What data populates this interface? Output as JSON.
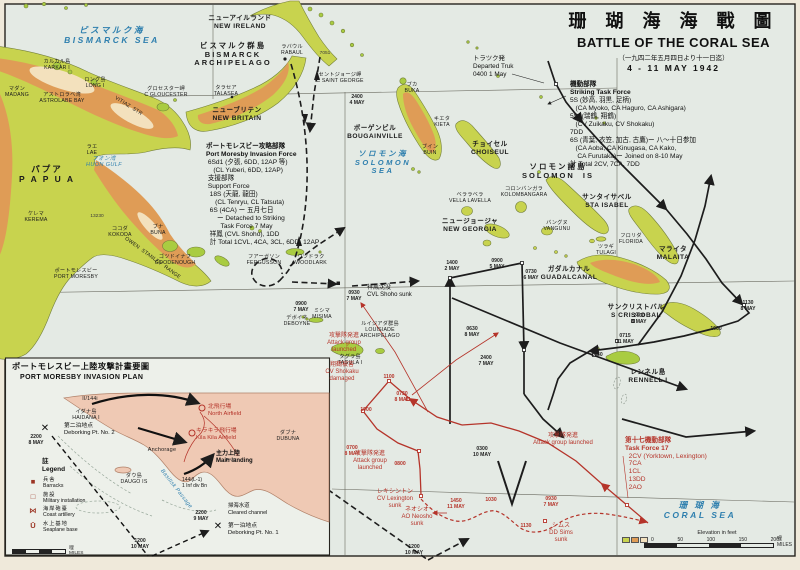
{
  "colors": {
    "sea": "#e4eae4",
    "paper": "#efe9da",
    "land": "#c8d34e",
    "land_bright": "#a9cc41",
    "highland": "#df9c56",
    "highland_light": "#f3e1bd",
    "inset_land": "#efc9b4",
    "track_black": "#1d1d1d",
    "track_red": "#b5342a",
    "sea_label": "#2e7fae",
    "frame": "#26241f"
  },
  "title": {
    "jp": "珊 瑚 海 海 戰 圖",
    "en": "BATTLE OF THE CORAL SEA",
    "date_jp": "（一九四二年五月四日より十一日迄）",
    "date_en": "4 - 11 MAY 1942"
  },
  "scales": {
    "main": {
      "caption": "Elevation in feet",
      "ticks": [
        "0",
        "50",
        "100",
        "150",
        "200"
      ],
      "unit_jp": "哩",
      "unit_en": "MILES"
    },
    "inset": {
      "unit_jp": "哩",
      "unit_en": "MILES"
    }
  },
  "inset": {
    "legend": {
      "title_jp": "註",
      "title_en": "Legend",
      "items": [
        {
          "sym": "■",
          "jp": "兵舎",
          "en": "Barracks"
        },
        {
          "sym": "□",
          "jp": "施設",
          "en": "Military installation"
        },
        {
          "sym": "⋈",
          "jp": "海岸砲臺",
          "en": "Coast artillery"
        },
        {
          "sym": "Ū",
          "jp": "水上基地",
          "en": "Seaplane base"
        }
      ]
    }
  },
  "map_labels": [
    {
      "x": 112,
      "y": 26,
      "c": "sea",
      "L": [
        "ビスマルク海",
        "BISMARCK SEA"
      ],
      "n": "bismarck-sea-label"
    },
    {
      "x": 383,
      "y": 150,
      "c": "sea",
      "s": 7.5,
      "L": [
        "ソロモン海",
        "SOLOMON",
        "SEA"
      ],
      "n": "solomon-sea-label"
    },
    {
      "x": 700,
      "y": 501,
      "c": "sea",
      "L": [
        "珊 瑚 海",
        "CORAL SEA"
      ],
      "n": "coral-sea-label"
    },
    {
      "x": 104,
      "y": 156,
      "c": "sea-sm",
      "L": [
        "フオン湾",
        "HUON GULF"
      ],
      "n": "huon-gulf-label"
    },
    {
      "x": 240,
      "y": 15,
      "c": "isl",
      "L": [
        "ニューアイルランド",
        "NEW IRELAND"
      ]
    },
    {
      "x": 233,
      "y": 42,
      "c": "isl-lg",
      "s": 7.5,
      "L": [
        "ビスマルク群島",
        "BISMARCK",
        "ARCHIPELAGO"
      ]
    },
    {
      "x": 237,
      "y": 107,
      "c": "isl",
      "L": [
        "ニューブリテン",
        "NEW BRITAIN"
      ]
    },
    {
      "x": 47,
      "y": 165,
      "c": "isl-lg",
      "L": [
        "パプア",
        "P A P U A"
      ]
    },
    {
      "x": 558,
      "y": 163,
      "c": "isl-lg",
      "s": 7.5,
      "L": [
        "ソロモン諸島",
        "SOLOMON  IS"
      ]
    },
    {
      "x": 375,
      "y": 125,
      "c": "isl",
      "L": [
        "ボーゲンビル",
        "BOUGAINVILLE"
      ]
    },
    {
      "x": 490,
      "y": 141,
      "c": "isl",
      "L": [
        "チョイセル",
        "CHOISEUL"
      ]
    },
    {
      "x": 607,
      "y": 194,
      "c": "isl",
      "L": [
        "サンタイサベル",
        "STA ISABEL"
      ]
    },
    {
      "x": 470,
      "y": 218,
      "c": "isl",
      "L": [
        "ニュージョージャ",
        "NEW GEORGIA"
      ]
    },
    {
      "x": 673,
      "y": 246,
      "c": "isl",
      "L": [
        "マライタ",
        "MALAITA"
      ]
    },
    {
      "x": 569,
      "y": 266,
      "c": "isl",
      "L": [
        "ガダルカナル",
        "GUADALCANAL"
      ]
    },
    {
      "x": 636,
      "y": 304,
      "c": "isl",
      "L": [
        "サンクリストバル",
        "S CRISTOBAL"
      ]
    },
    {
      "x": 648,
      "y": 369,
      "c": "isl",
      "L": [
        "レンネル島",
        "RENNELL I"
      ]
    },
    {
      "x": 380,
      "y": 322,
      "c": "isl-sm",
      "L": [
        "ルイジアダ群島",
        "LOUISIADE",
        "ARCHIPELAGO"
      ]
    },
    {
      "x": 292,
      "y": 45,
      "c": "isl-sm",
      "L": [
        "ラバウル",
        "RABAUL"
      ]
    },
    {
      "x": 166,
      "y": 87,
      "c": "isl-sm",
      "L": [
        "グロセスター岬",
        "C GLOUCESTER"
      ]
    },
    {
      "x": 226,
      "y": 86,
      "c": "isl-sm",
      "L": [
        "タラセア",
        "TALASEA"
      ]
    },
    {
      "x": 57,
      "y": 60,
      "c": "isl-sm",
      "L": [
        "カルカル島",
        "KARKAR I"
      ]
    },
    {
      "x": 17,
      "y": 87,
      "c": "isl-sm",
      "L": [
        "マダン",
        "MADANG"
      ]
    },
    {
      "x": 62,
      "y": 93,
      "c": "isl-sm",
      "L": [
        "アストロラベ湾",
        "ASTROLABE BAY"
      ]
    },
    {
      "x": 95,
      "y": 78,
      "c": "isl-sm",
      "L": [
        "ロング島",
        "LONG I"
      ]
    },
    {
      "x": 128,
      "y": 104,
      "c": "isl-sm",
      "r": 32,
      "L": [
        "VITIAZ  STR"
      ]
    },
    {
      "x": 92,
      "y": 145,
      "c": "isl-sm",
      "L": [
        "ラエ",
        "LAE"
      ]
    },
    {
      "x": 36,
      "y": 212,
      "c": "isl-sm",
      "L": [
        "ケレマ",
        "KEREMA"
      ]
    },
    {
      "x": 120,
      "y": 227,
      "c": "isl-sm",
      "L": [
        "ココダ",
        "KOKODA"
      ]
    },
    {
      "x": 158,
      "y": 225,
      "c": "isl-sm",
      "L": [
        "ブナ",
        "BUNA"
      ]
    },
    {
      "x": 97,
      "y": 214,
      "c": "elev",
      "L": [
        "13230"
      ]
    },
    {
      "x": 152,
      "y": 256,
      "c": "isl-sm",
      "r": 36,
      "L": [
        "OWEN  STANLEY  RANGE"
      ]
    },
    {
      "x": 76,
      "y": 269,
      "c": "isl-sm",
      "L": [
        "ポートモレスビー",
        "PORT MORESBY"
      ]
    },
    {
      "x": 175,
      "y": 255,
      "c": "isl-sm",
      "L": [
        "ゴツドイナフ",
        "GOODENOUGH"
      ]
    },
    {
      "x": 264,
      "y": 255,
      "c": "isl-sm",
      "L": [
        "フアーガソン",
        "FERGUSSON"
      ]
    },
    {
      "x": 311,
      "y": 255,
      "c": "isl-sm",
      "L": [
        "ウツドラク",
        "WOODLARK"
      ]
    },
    {
      "x": 297,
      "y": 316,
      "c": "isl-sm",
      "L": [
        "デボイネ",
        "DEBOYNE"
      ]
    },
    {
      "x": 322,
      "y": 309,
      "c": "isl-sm",
      "L": [
        "ミシマ",
        "MISIMA"
      ]
    },
    {
      "x": 350,
      "y": 355,
      "c": "isl-sm",
      "L": [
        "タグラ島",
        "TAGULA I"
      ]
    },
    {
      "x": 412,
      "y": 83,
      "c": "isl-sm",
      "L": [
        "ブカ",
        "BUKA"
      ]
    },
    {
      "x": 442,
      "y": 117,
      "c": "isl-sm",
      "L": [
        "キエタ",
        "KIETA"
      ]
    },
    {
      "x": 430,
      "y": 145,
      "c": "isl-sm",
      "L": [
        "ブイン",
        "BUIN"
      ]
    },
    {
      "x": 340,
      "y": 73,
      "c": "isl-sm",
      "L": [
        "セントジョージ岬",
        "C SAINT GEORGE"
      ]
    },
    {
      "x": 325,
      "y": 51,
      "c": "elev",
      "L": [
        "7051"
      ]
    },
    {
      "x": 524,
      "y": 187,
      "c": "isl-sm",
      "L": [
        "コロンバンガラ",
        "KOLOMBANGARA"
      ]
    },
    {
      "x": 470,
      "y": 193,
      "c": "isl-sm",
      "L": [
        "ベララベラ",
        "VELLA LAVELLA"
      ]
    },
    {
      "x": 557,
      "y": 221,
      "c": "isl-sm",
      "L": [
        "バングヌ",
        "VANGUNU"
      ]
    },
    {
      "x": 631,
      "y": 234,
      "c": "isl-sm",
      "L": [
        "フロリダ",
        "FLORIDA"
      ]
    },
    {
      "x": 606,
      "y": 245,
      "c": "isl-sm",
      "L": [
        "ツラギ",
        "TULAGI"
      ]
    },
    {
      "x": 473,
      "y": 55,
      "c": "blk",
      "s": 6.4,
      "lf": 1,
      "L": [
        "トラツク発",
        "Departed Truk",
        "0400 1 May"
      ],
      "n": "departed-truk-note"
    },
    {
      "x": 570,
      "y": 81,
      "c": "blk hb",
      "s": 6.6,
      "lf": 1,
      "n": "striking-task-force-note",
      "L": [
        "機動部隊",
        "Striking Task Force",
        "5S (妙高, 羽黒, 足柄)",
        "   (CA Myoko, CA Haguro, CA Ashigara)",
        "5Sf (瑞鶴, 翔鶴)",
        "   (CV Zuikaku, CV Shokaku)",
        "7DD",
        "6S (青葉, 衣笠, 加古, 古鷹)ー 八〜十日参加",
        "   (CA Aoba, CA Kinugasa, CA Kako,",
        "    CA Furutaka)ー Joined on 8-10 May",
        "計 Total 2CV, 7CA, 7DD"
      ]
    },
    {
      "x": 206,
      "y": 143,
      "c": "blk hb",
      "s": 6.6,
      "lf": 1,
      "n": "port-moresby-invasion-force-note",
      "L": [
        "ポートモレスビー攻略部隊",
        "Port Moresby Invasion Force",
        " 6Sd1 (夕張, 6DD, 12AP 等)",
        "    (CL Yuberi, 6DD, 12AP)",
        " 支援部隊",
        " Support Force",
        "  18S (天龍, 龍田)",
        "     (CL Tenryu, CL Tatsuta)",
        "  6S (4CA) ー 五月七日",
        "      ー Detached to Striking",
        "        Task Force 7 May",
        "  祥鳳 (CVL Shoho), 1DD",
        "  計 Total 1CVL, 4CA, 3CL, 6DD, 12AP"
      ]
    },
    {
      "x": 625,
      "y": 437,
      "c": "rblk hb",
      "s": 6.6,
      "lf": 1,
      "n": "task-force-17-note",
      "L": [
        "第十七機動部隊",
        "Task Force 17",
        "  2CV (Yorktown, Lexington)",
        "  7CA",
        "  1CL",
        "  13DD",
        "  2AO"
      ]
    },
    {
      "x": 367,
      "y": 285,
      "c": "blk",
      "s": 6,
      "lf": 1,
      "L": [
        "祥鳳沈没",
        "CVL Shoho sunk"
      ],
      "n": "shoho-sunk-note"
    },
    {
      "x": 344,
      "y": 333,
      "c": "red",
      "L": [
        "攻撃隊発進",
        "Attack group",
        "launched"
      ],
      "n": "attack-group-launched-note"
    },
    {
      "x": 342,
      "y": 362,
      "c": "red",
      "L": [
        "翔鶴被害",
        "CV Shokaku",
        "damaged"
      ],
      "n": "shokaku-damaged-note"
    },
    {
      "x": 370,
      "y": 451,
      "c": "red",
      "L": [
        "攻撃隊発進",
        "Attack group",
        "launched"
      ],
      "n": "attack-group-launched-note"
    },
    {
      "x": 563,
      "y": 433,
      "c": "red",
      "L": [
        "攻撃隊発進",
        "Attack group launched"
      ],
      "n": "attack-group-launched-note"
    },
    {
      "x": 395,
      "y": 489,
      "c": "red",
      "L": [
        "レキシントン",
        "CV Lexington",
        "sunk"
      ],
      "n": "lexington-sunk-note"
    },
    {
      "x": 417,
      "y": 507,
      "c": "red",
      "L": [
        "ネオシオ",
        "AO Neosho",
        "sunk"
      ],
      "n": "neosho-sunk-note"
    },
    {
      "x": 561,
      "y": 523,
      "c": "red",
      "L": [
        "シムス",
        "DD Sims",
        "sunk"
      ],
      "n": "sims-sunk-note"
    },
    {
      "x": 357,
      "y": 95,
      "c": "time",
      "L": [
        "2400",
        "4 MAY"
      ]
    },
    {
      "x": 452,
      "y": 261,
      "c": "time",
      "L": [
        "1400",
        "2 MAY"
      ]
    },
    {
      "x": 497,
      "y": 259,
      "c": "time",
      "L": [
        "0900",
        "5 MAY"
      ]
    },
    {
      "x": 531,
      "y": 270,
      "c": "time",
      "L": [
        "0730",
        "6 MAY"
      ]
    },
    {
      "x": 472,
      "y": 327,
      "c": "time",
      "L": [
        "0630",
        "8 MAY"
      ]
    },
    {
      "x": 486,
      "y": 356,
      "c": "time",
      "L": [
        "2400",
        "7 MAY"
      ]
    },
    {
      "x": 639,
      "y": 314,
      "c": "time",
      "L": [
        "2400",
        "8 MAY"
      ]
    },
    {
      "x": 748,
      "y": 301,
      "c": "time",
      "L": [
        "1130",
        "8 MAY"
      ]
    },
    {
      "x": 625,
      "y": 334,
      "c": "time",
      "L": [
        "0715",
        "11 MAY"
      ]
    },
    {
      "x": 716,
      "y": 327,
      "c": "time",
      "L": [
        "1600"
      ]
    },
    {
      "x": 597,
      "y": 353,
      "c": "time",
      "L": [
        "1630"
      ]
    },
    {
      "x": 482,
      "y": 447,
      "c": "time",
      "L": [
        "0300",
        "10 MAY"
      ]
    },
    {
      "x": 414,
      "y": 545,
      "c": "time",
      "L": [
        "1200",
        "10 MAY"
      ]
    },
    {
      "x": 354,
      "y": 291,
      "c": "time",
      "L": [
        "0930",
        "7 MAY"
      ]
    },
    {
      "x": 301,
      "y": 302,
      "c": "time",
      "L": [
        "0900",
        "7 MAY"
      ]
    },
    {
      "x": 352,
      "y": 446,
      "c": "rtime",
      "L": [
        "0700",
        "8 MAY"
      ]
    },
    {
      "x": 400,
      "y": 462,
      "c": "rtime",
      "L": [
        "0800"
      ]
    },
    {
      "x": 389,
      "y": 375,
      "c": "rtime",
      "L": [
        "1100"
      ]
    },
    {
      "x": 366,
      "y": 408,
      "c": "rtime",
      "L": [
        "1900"
      ]
    },
    {
      "x": 402,
      "y": 392,
      "c": "rtime",
      "L": [
        "0730",
        "8 MAY"
      ]
    },
    {
      "x": 551,
      "y": 497,
      "c": "rtime",
      "L": [
        "0930",
        "7 MAY"
      ]
    },
    {
      "x": 491,
      "y": 498,
      "c": "rtime",
      "L": [
        "1030"
      ]
    },
    {
      "x": 526,
      "y": 524,
      "c": "rtime",
      "L": [
        "1130"
      ]
    },
    {
      "x": 456,
      "y": 499,
      "c": "rtime",
      "L": [
        "1450",
        "11 MAY"
      ]
    },
    {
      "x": 12,
      "y": 362,
      "c": "ititle",
      "lf": 1,
      "L": [
        "ポートモレスビー上陸攻撃計畫要圖"
      ],
      "n": "inset-title-jp"
    },
    {
      "x": 20,
      "y": 374,
      "c": "ititle",
      "s": 7,
      "lf": 1,
      "L": [
        "PORT MORESBY INVASION PLAN"
      ],
      "n": "inset-title-en"
    },
    {
      "x": 90,
      "y": 397,
      "c": "isl-sm",
      "L": [
        "II/144i"
      ]
    },
    {
      "x": 86,
      "y": 410,
      "c": "isl-sm",
      "L": [
        "イダナ島",
        "HAIDANA I"
      ]
    },
    {
      "x": 64,
      "y": 423,
      "c": "blk",
      "s": 5.8,
      "lf": 1,
      "L": [
        "第二泊地点",
        "Deborking Pt. No. 2"
      ],
      "n": "deboarding-point-2-label"
    },
    {
      "x": 36,
      "y": 435,
      "c": "time",
      "L": [
        "2200",
        "8 MAY"
      ]
    },
    {
      "x": 162,
      "y": 447,
      "c": "isl-sm",
      "s": 5.5,
      "L": [
        "Anchorage"
      ]
    },
    {
      "x": 134,
      "y": 474,
      "c": "isl-sm",
      "L": [
        "ダウ島",
        "DAUGO IS"
      ]
    },
    {
      "x": 208,
      "y": 404,
      "c": "rblk",
      "s": 5.8,
      "lf": 1,
      "L": [
        "北飛行場",
        "North Airfield"
      ],
      "n": "north-airfield-label"
    },
    {
      "x": 196,
      "y": 428,
      "c": "rblk",
      "s": 5.8,
      "lf": 1,
      "L": [
        "キラキラ飛行場",
        "Kila Kila Airfield"
      ],
      "n": "kila-kila-airfield-label"
    },
    {
      "x": 216,
      "y": 451,
      "c": "mld",
      "lf": 1,
      "L": [
        "主力上陸",
        "Main landing"
      ],
      "n": "main-landing-label"
    },
    {
      "x": 182,
      "y": 477,
      "c": "blk",
      "s": 5,
      "lf": 1,
      "L": [
        "144i(L-1)",
        "1 Inf div Bn"
      ]
    },
    {
      "x": 288,
      "y": 431,
      "c": "isl-sm",
      "L": [
        "ダブナ",
        "DUBUNA"
      ]
    },
    {
      "x": 231,
      "y": 458,
      "c": "elev",
      "L": [
        "PARI"
      ]
    },
    {
      "x": 228,
      "y": 523,
      "c": "blk",
      "s": 5.8,
      "lf": 1,
      "L": [
        "第一泊地点",
        "Deborking Pt. No. 1"
      ],
      "n": "deboarding-point-1-label"
    },
    {
      "x": 201,
      "y": 511,
      "c": "time",
      "L": [
        "2200",
        "9 MAY"
      ]
    },
    {
      "x": 228,
      "y": 503,
      "c": "blk",
      "s": 5.4,
      "lf": 1,
      "L": [
        "掃海水道",
        "Cleared channel"
      ],
      "n": "cleared-channel-label"
    },
    {
      "x": 140,
      "y": 539,
      "c": "time",
      "L": [
        "1200",
        "10 MAY"
      ]
    },
    {
      "x": 45,
      "y": 423,
      "c": "xmark",
      "L": [
        "✕"
      ],
      "n": "deboarding-point-2-mark"
    },
    {
      "x": 218,
      "y": 521,
      "c": "xmark",
      "L": [
        "✕"
      ],
      "n": "deboarding-point-1-mark"
    },
    {
      "x": 176,
      "y": 486,
      "c": "sea-sm",
      "r": 52,
      "L": [
        "Basilisk Passage"
      ]
    }
  ]
}
